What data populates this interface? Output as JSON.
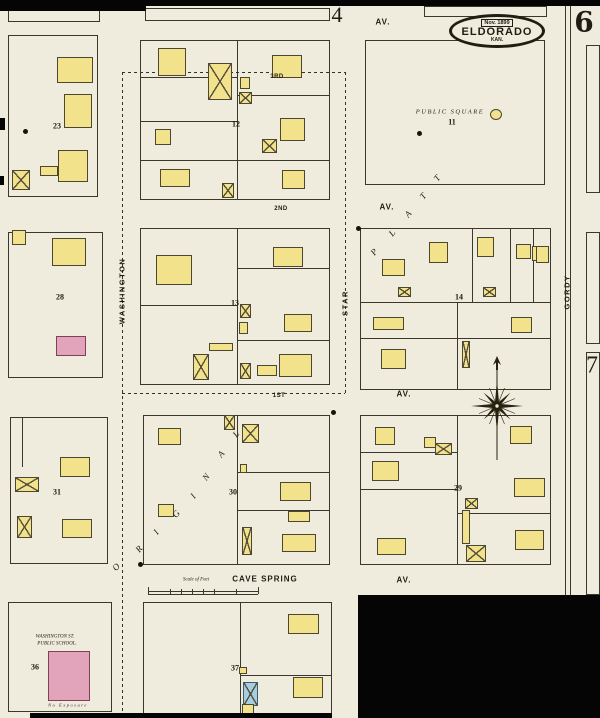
{
  "badge": {
    "date": "Nov. 1899",
    "city": "ELDORADO",
    "state": "KAN."
  },
  "map": {
    "colors": {
      "paper": "#efecdd",
      "black": "#050505",
      "ink": "#3a372c",
      "yellow": "#f2e28c",
      "pink": "#e2a4bb",
      "blue": "#a6cde0"
    },
    "paper_shapes": [
      [
        0,
        6,
        600,
        589
      ],
      [
        0,
        595,
        358,
        123
      ]
    ],
    "black_patches": [
      [
        0,
        0,
        600,
        6
      ],
      [
        0,
        0,
        146,
        11
      ],
      [
        358,
        595,
        242,
        123
      ],
      [
        30,
        713,
        302,
        5
      ],
      [
        0,
        118,
        5,
        12
      ],
      [
        0,
        176,
        4,
        9
      ]
    ],
    "blocks": [
      [
        8,
        10,
        92,
        12
      ],
      [
        145,
        8,
        185,
        13
      ],
      [
        424,
        6,
        123,
        11
      ],
      [
        8,
        35,
        90,
        162
      ],
      [
        8,
        232,
        95,
        146
      ],
      [
        10,
        417,
        98,
        147
      ],
      [
        8,
        602,
        104,
        110
      ],
      [
        140,
        40,
        190,
        160
      ],
      [
        140,
        228,
        190,
        157
      ],
      [
        143,
        415,
        187,
        150
      ],
      [
        143,
        602,
        189,
        114
      ],
      [
        365,
        40,
        180,
        145
      ],
      [
        360,
        228,
        191,
        162
      ],
      [
        360,
        415,
        191,
        150
      ],
      [
        586,
        45,
        14,
        148
      ],
      [
        586,
        232,
        14,
        112
      ],
      [
        586,
        352,
        14,
        243
      ]
    ],
    "lines": [
      [
        237,
        40,
        237,
        200
      ],
      [
        140,
        77,
        237,
        77
      ],
      [
        237,
        95,
        330,
        95
      ],
      [
        140,
        121,
        237,
        121
      ],
      [
        140,
        160,
        330,
        160
      ],
      [
        237,
        228,
        237,
        385
      ],
      [
        140,
        305,
        237,
        305
      ],
      [
        237,
        268,
        330,
        268
      ],
      [
        237,
        340,
        330,
        340
      ],
      [
        237,
        415,
        237,
        565
      ],
      [
        237,
        472,
        330,
        472
      ],
      [
        237,
        510,
        330,
        510
      ],
      [
        240,
        602,
        240,
        716
      ],
      [
        240,
        675,
        332,
        675
      ],
      [
        360,
        302,
        551,
        302
      ],
      [
        360,
        338,
        551,
        338
      ],
      [
        457,
        302,
        457,
        390
      ],
      [
        472,
        228,
        472,
        302
      ],
      [
        510,
        228,
        510,
        302
      ],
      [
        533,
        228,
        533,
        302
      ],
      [
        457,
        415,
        457,
        565
      ],
      [
        360,
        452,
        457,
        452
      ],
      [
        360,
        489,
        457,
        489
      ],
      [
        457,
        513,
        551,
        513
      ],
      [
        565,
        6,
        565,
        598
      ],
      [
        570,
        6,
        570,
        598
      ],
      [
        22,
        417,
        22,
        467
      ],
      [
        148,
        591,
        258,
        591
      ],
      [
        148,
        594,
        258,
        594
      ],
      [
        148,
        587,
        148,
        594
      ],
      [
        170,
        589,
        170,
        594
      ],
      [
        181,
        589,
        181,
        594
      ],
      [
        192,
        589,
        192,
        594
      ],
      [
        203,
        589,
        203,
        594
      ],
      [
        214,
        589,
        214,
        594
      ],
      [
        236,
        589,
        236,
        594
      ],
      [
        258,
        587,
        258,
        594
      ]
    ],
    "dashed": [
      [
        122,
        72,
        122,
        718
      ],
      [
        345,
        72,
        345,
        393
      ],
      [
        122,
        72,
        345,
        72
      ],
      [
        122,
        393,
        345,
        393
      ]
    ],
    "buildings": [
      [
        57,
        57,
        36,
        26,
        "y",
        ""
      ],
      [
        64,
        94,
        28,
        34,
        "y",
        ""
      ],
      [
        58,
        150,
        30,
        32,
        "y",
        ""
      ],
      [
        40,
        166,
        18,
        10,
        "y",
        ""
      ],
      [
        12,
        170,
        18,
        20,
        "y",
        "m"
      ],
      [
        12,
        230,
        14,
        15,
        "y",
        ""
      ],
      [
        52,
        238,
        34,
        28,
        "y",
        ""
      ],
      [
        56,
        336,
        30,
        20,
        "p",
        ""
      ],
      [
        60,
        457,
        30,
        20,
        "y",
        ""
      ],
      [
        15,
        477,
        24,
        15,
        "y",
        "m"
      ],
      [
        17,
        516,
        15,
        22,
        "y",
        "m"
      ],
      [
        62,
        519,
        30,
        19,
        "y",
        ""
      ],
      [
        48,
        651,
        42,
        50,
        "p",
        ""
      ],
      [
        158,
        48,
        28,
        28,
        "y",
        ""
      ],
      [
        208,
        63,
        24,
        37,
        "y",
        "m"
      ],
      [
        272,
        55,
        30,
        23,
        "y",
        ""
      ],
      [
        240,
        77,
        10,
        12,
        "y",
        ""
      ],
      [
        239,
        92,
        13,
        12,
        "y",
        "m"
      ],
      [
        155,
        129,
        16,
        16,
        "y",
        ""
      ],
      [
        262,
        139,
        15,
        14,
        "y",
        "m"
      ],
      [
        280,
        118,
        25,
        23,
        "y",
        ""
      ],
      [
        160,
        169,
        30,
        18,
        "y",
        ""
      ],
      [
        222,
        183,
        12,
        15,
        "y",
        "m"
      ],
      [
        282,
        170,
        23,
        19,
        "y",
        ""
      ],
      [
        156,
        255,
        36,
        30,
        "y",
        ""
      ],
      [
        273,
        247,
        30,
        20,
        "y",
        ""
      ],
      [
        240,
        304,
        11,
        14,
        "y",
        "m"
      ],
      [
        284,
        314,
        28,
        18,
        "y",
        ""
      ],
      [
        239,
        322,
        9,
        12,
        "y",
        ""
      ],
      [
        193,
        354,
        16,
        26,
        "y",
        "m"
      ],
      [
        209,
        343,
        24,
        8,
        "y",
        ""
      ],
      [
        257,
        365,
        20,
        11,
        "y",
        ""
      ],
      [
        279,
        354,
        33,
        23,
        "y",
        ""
      ],
      [
        240,
        363,
        11,
        16,
        "y",
        "m"
      ],
      [
        158,
        428,
        23,
        17,
        "y",
        ""
      ],
      [
        224,
        415,
        11,
        15,
        "y",
        "m"
      ],
      [
        242,
        424,
        17,
        19,
        "y",
        "m"
      ],
      [
        158,
        504,
        16,
        13,
        "y",
        ""
      ],
      [
        280,
        482,
        31,
        19,
        "y",
        ""
      ],
      [
        288,
        511,
        22,
        11,
        "y",
        ""
      ],
      [
        282,
        534,
        34,
        18,
        "y",
        ""
      ],
      [
        242,
        527,
        10,
        28,
        "y",
        "m"
      ],
      [
        240,
        464,
        7,
        9,
        "y",
        ""
      ],
      [
        288,
        614,
        31,
        20,
        "y",
        ""
      ],
      [
        243,
        682,
        15,
        24,
        "b",
        "m"
      ],
      [
        293,
        677,
        30,
        21,
        "y",
        ""
      ],
      [
        239,
        667,
        8,
        7,
        "y",
        ""
      ],
      [
        242,
        704,
        12,
        12,
        "y",
        ""
      ],
      [
        490,
        109,
        12,
        11,
        "y",
        "r"
      ],
      [
        382,
        259,
        23,
        17,
        "y",
        ""
      ],
      [
        429,
        242,
        19,
        21,
        "y",
        ""
      ],
      [
        477,
        237,
        17,
        20,
        "y",
        ""
      ],
      [
        516,
        244,
        15,
        15,
        "y",
        ""
      ],
      [
        532,
        246,
        15,
        15,
        "y",
        ""
      ],
      [
        398,
        287,
        13,
        10,
        "y",
        "m"
      ],
      [
        483,
        287,
        13,
        10,
        "y",
        "m"
      ],
      [
        373,
        317,
        31,
        13,
        "y",
        ""
      ],
      [
        511,
        317,
        21,
        16,
        "y",
        ""
      ],
      [
        381,
        349,
        25,
        20,
        "y",
        ""
      ],
      [
        462,
        341,
        8,
        27,
        "y",
        "m"
      ],
      [
        375,
        427,
        20,
        18,
        "y",
        ""
      ],
      [
        372,
        461,
        27,
        20,
        "y",
        ""
      ],
      [
        377,
        538,
        29,
        17,
        "y",
        ""
      ],
      [
        424,
        437,
        12,
        11,
        "y",
        ""
      ],
      [
        435,
        443,
        17,
        12,
        "y",
        "m"
      ],
      [
        465,
        498,
        13,
        11,
        "y",
        "m"
      ],
      [
        510,
        426,
        22,
        18,
        "y",
        ""
      ],
      [
        514,
        478,
        31,
        19,
        "y",
        ""
      ],
      [
        515,
        530,
        29,
        20,
        "y",
        ""
      ],
      [
        466,
        545,
        20,
        17,
        "y",
        "m"
      ],
      [
        462,
        510,
        8,
        34,
        "y",
        ""
      ],
      [
        536,
        246,
        13,
        17,
        "y",
        ""
      ]
    ],
    "dots": [
      [
        25,
        131
      ],
      [
        419,
        133
      ],
      [
        358,
        228
      ],
      [
        333,
        412
      ],
      [
        140,
        564
      ]
    ],
    "labels": [
      [
        "AV.",
        383,
        22,
        "av",
        0
      ],
      [
        "AV.",
        387,
        207,
        "av",
        0
      ],
      [
        "AV.",
        404,
        394,
        "av",
        0
      ],
      [
        "AV.",
        404,
        580,
        "av",
        0
      ],
      [
        "CAVE SPRING",
        265,
        579,
        "av",
        0
      ],
      [
        "3RD",
        277,
        77,
        "stn",
        0
      ],
      [
        "2ND",
        281,
        209,
        "stn",
        0
      ],
      [
        "1ST",
        279,
        396,
        "stn",
        0
      ],
      [
        "WASHINGTON",
        122,
        291,
        "vst",
        -90
      ],
      [
        "STAR",
        345,
        303,
        "vst",
        -90
      ],
      [
        "GORDY",
        567,
        292,
        "vst",
        -90
      ],
      [
        "PUBLIC SQUARE",
        450,
        112,
        "ps",
        0
      ],
      [
        "11",
        452,
        122,
        "bn",
        0
      ],
      [
        "23",
        57,
        126,
        "bn",
        0
      ],
      [
        "28",
        60,
        297,
        "bn",
        0
      ],
      [
        "31",
        57,
        492,
        "bn",
        0
      ],
      [
        "36",
        35,
        667,
        "bn",
        0
      ],
      [
        "12",
        236,
        124,
        "bn",
        0
      ],
      [
        "13",
        235,
        303,
        "bn",
        0
      ],
      [
        "30",
        233,
        492,
        "bn",
        0
      ],
      [
        "37",
        235,
        668,
        "bn",
        0
      ],
      [
        "14",
        459,
        297,
        "bn",
        0
      ],
      [
        "29",
        458,
        488,
        "bn",
        0
      ],
      [
        "4",
        337,
        15,
        "n4",
        0
      ],
      [
        "6",
        584,
        22,
        "n6",
        0
      ],
      [
        "7",
        592,
        366,
        "n7",
        0
      ],
      [
        "O",
        116,
        567,
        "diag",
        -50
      ],
      [
        "R",
        139,
        549,
        "diag",
        -50
      ],
      [
        "I",
        156,
        532,
        "diag",
        -50
      ],
      [
        "G",
        176,
        514,
        "diag",
        -50
      ],
      [
        "I",
        193,
        496,
        "diag",
        -50
      ],
      [
        "N",
        206,
        477,
        "diag",
        -50
      ],
      [
        "A",
        221,
        454,
        "diag",
        -50
      ],
      [
        "L",
        236,
        434,
        "diag",
        -50
      ],
      [
        "P",
        374,
        252,
        "diag",
        -50
      ],
      [
        "L",
        392,
        233,
        "diag",
        -50
      ],
      [
        "A",
        408,
        214,
        "diag",
        -50
      ],
      [
        "T",
        423,
        196,
        "diag",
        -50
      ],
      [
        "T",
        437,
        178,
        "diag",
        -50
      ],
      [
        "WASHINGTON ST.",
        55,
        637,
        "sch",
        0
      ],
      [
        "PUBLIC SCHOOL.",
        57,
        644,
        "sch",
        0
      ],
      [
        "Scale of Feet",
        196,
        580,
        "sch",
        0
      ],
      [
        "No Exposure",
        68,
        705,
        "noexp",
        0
      ]
    ],
    "badge_pos": {
      "x": 497,
      "y": 31
    },
    "compass_pos": {
      "x": 497,
      "y": 406
    }
  }
}
